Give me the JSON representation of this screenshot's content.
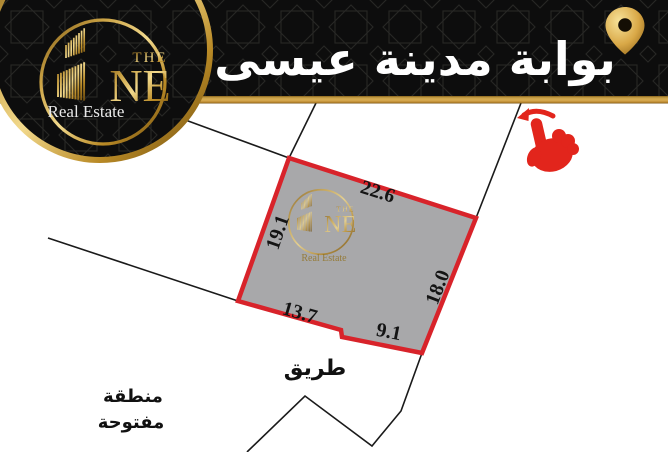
{
  "banner": {
    "title": "بوابة مدينة عيسى"
  },
  "logo": {
    "the": "THE",
    "ne": "NE",
    "tagline": "Real Estate"
  },
  "map": {
    "plot": {
      "fill_color": "#a8a8aa",
      "border_color": "#d8232a",
      "dimensions": {
        "top": "22.6",
        "left": "19.1",
        "right": "18.0",
        "bottom_left": "13.7",
        "bottom_right": "9.1"
      }
    },
    "labels": {
      "road": "طريق",
      "open_area_line1": "منطقة",
      "open_area_line2": "مفتوحة"
    }
  },
  "icons": {
    "pin": "location-pin",
    "hand": "swipe-left-hand"
  },
  "colors": {
    "gold": "#c79a36",
    "banner_black": "#0d0d0d",
    "hand_red": "#e2251c",
    "title_white": "#ffffff"
  }
}
